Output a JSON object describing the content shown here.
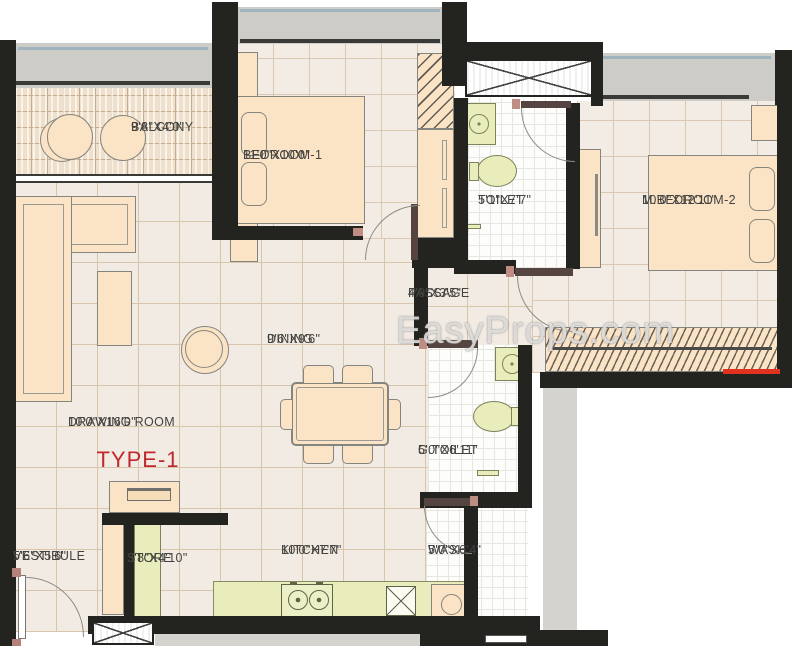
{
  "plan": {
    "type_label": "TYPE-1",
    "watermark": "EasyProps.com"
  },
  "rooms": {
    "balcony": {
      "name": "BALCONY",
      "dim": "9'8\"X4'0\""
    },
    "bedroom1": {
      "name": "BEDROOM-1",
      "dim": "11'0\"X10'0\""
    },
    "toilet": {
      "name": "TOILET",
      "dim": "5'1\"X7'7\""
    },
    "mbedroom2": {
      "name": "M.BEDROOM-2",
      "dim": "10'0\"X12'11\""
    },
    "passage": {
      "name": "PASSAGE",
      "dim": "4'9\"X3'5\""
    },
    "dining": {
      "name": "DINING",
      "dim": "9'6\"X9'6\""
    },
    "drawing": {
      "name": "DRAWING ROOM",
      "dim": "10'0\"X16'0\""
    },
    "gtoilet": {
      "name": "G.TOILET",
      "dim": "5'0\"X6'11\""
    },
    "vestibule": {
      "name": "VESTIBULE",
      "dim": "5'6\"X5'6\""
    },
    "store": {
      "name": "STORE",
      "dim": "3'8\"X4'10\""
    },
    "kitchen": {
      "name": "KITCHEN",
      "dim": "10'0\"X7'7\""
    },
    "wash": {
      "name": "WASH",
      "dim": "5'0\"X6'4\""
    }
  },
  "colors": {
    "wall": "#232320",
    "floor_tile": "#f2ebe3",
    "tile_grid": "#d9c4ac",
    "furniture": "#fbe3c6",
    "fixture_green": "#e9edbb",
    "window_band_gray": "#cdccc7",
    "accent_red": "#c1272d",
    "marker_red": "#e0321e"
  }
}
